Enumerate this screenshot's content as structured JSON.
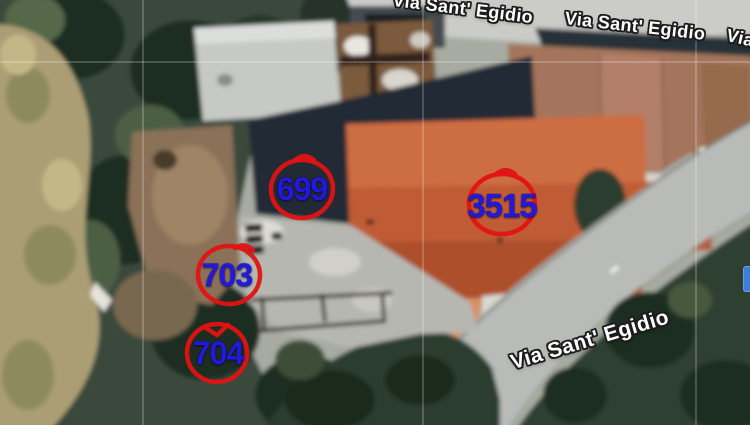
{
  "map": {
    "view_type": "satellite",
    "street_labels": [
      {
        "id": "top-left-partial",
        "text": "Via Sant' Egidio"
      },
      {
        "id": "top-right",
        "text": "Via Sant' Egidio"
      },
      {
        "id": "right-edge-partial",
        "text": "Via Sant' Egidio"
      },
      {
        "id": "bottom",
        "text": "Via Sant' Egidio"
      }
    ],
    "parcels": [
      {
        "number": "699"
      },
      {
        "number": "3515"
      },
      {
        "number": "703"
      },
      {
        "number": "704"
      }
    ],
    "colors": {
      "parcel_number": "#2418dd",
      "parcel_circle": "#e21313",
      "street_text": "#ffffff",
      "street_outline": "#1c1c1c",
      "roof_main": "#c05c34",
      "roof_secondary": "#a4755c",
      "road": "#b8bbb7",
      "trees": "#2d3f31"
    }
  }
}
